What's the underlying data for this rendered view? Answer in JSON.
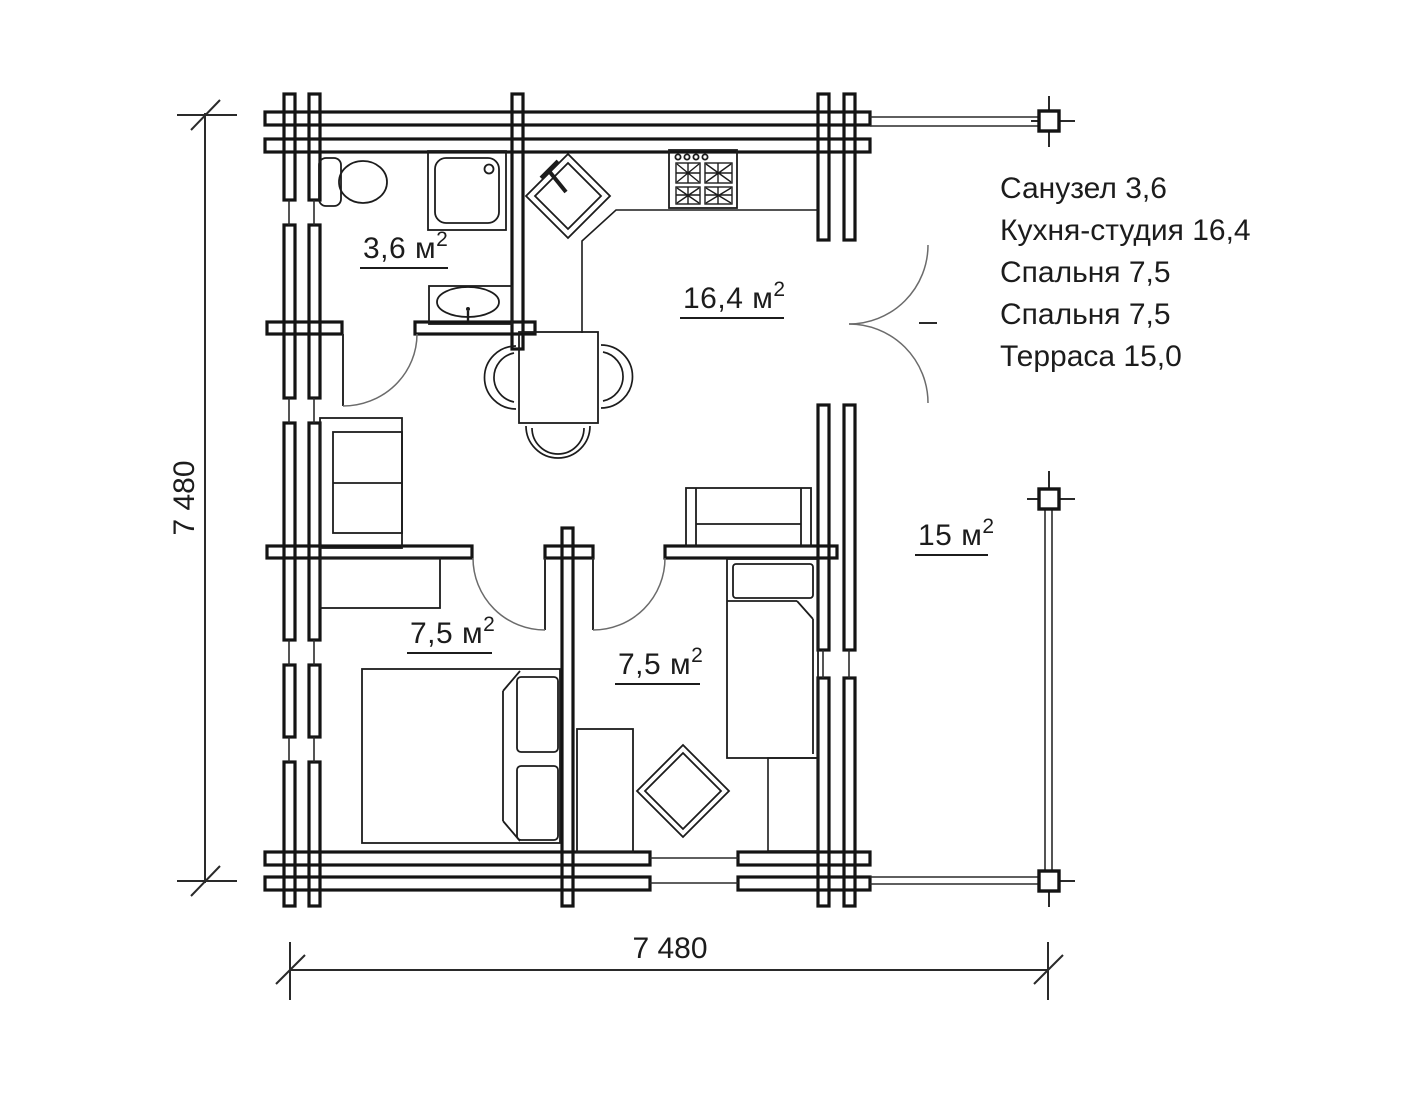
{
  "plan_type": "floor-plan",
  "colors": {
    "background": "#ffffff",
    "wall_line": "#141414",
    "thin_line": "#2a2a2a",
    "door_arc": "#6b6b6b",
    "text": "#1c1c1c"
  },
  "rooms": {
    "bathroom": {
      "label": "3,6 м",
      "sup": "2"
    },
    "kitchen": {
      "label": "16,4 м",
      "sup": "2"
    },
    "bedroom1": {
      "label": "7,5 м",
      "sup": "2"
    },
    "bedroom2": {
      "label": "7,5 м",
      "sup": "2"
    },
    "terrace": {
      "label": "15 м",
      "sup": "2"
    }
  },
  "legend": [
    "Санузел 3,6",
    "Кухня-студия 16,4",
    "Спальня 7,5",
    "Спальня 7,5",
    "Терраса 15,0"
  ],
  "dimensions": {
    "horizontal": "7 480",
    "vertical": "7 480"
  }
}
